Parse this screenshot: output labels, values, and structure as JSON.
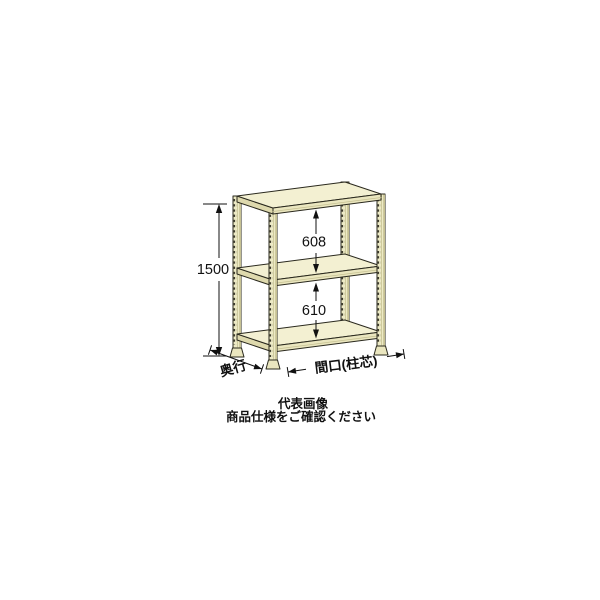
{
  "diagram": {
    "dimensions": {
      "height_label": "1500",
      "upper_gap_label": "608",
      "lower_gap_label": "610",
      "depth_label": "奥行",
      "width_label": "間口(柱芯)"
    },
    "caption": {
      "line1": "代表画像",
      "line2": "商品仕様をご確認ください"
    }
  },
  "colors": {
    "background": "#ffffff",
    "shelf_top": "#f3f0d2",
    "shelf_front": "#eae6bf",
    "shelf_side": "#ded9ad",
    "post": "#edeac5",
    "post_shade": "#c6c193",
    "post_hole": "#3a382a",
    "outline": "#2a291e",
    "dimension": "#111111"
  }
}
